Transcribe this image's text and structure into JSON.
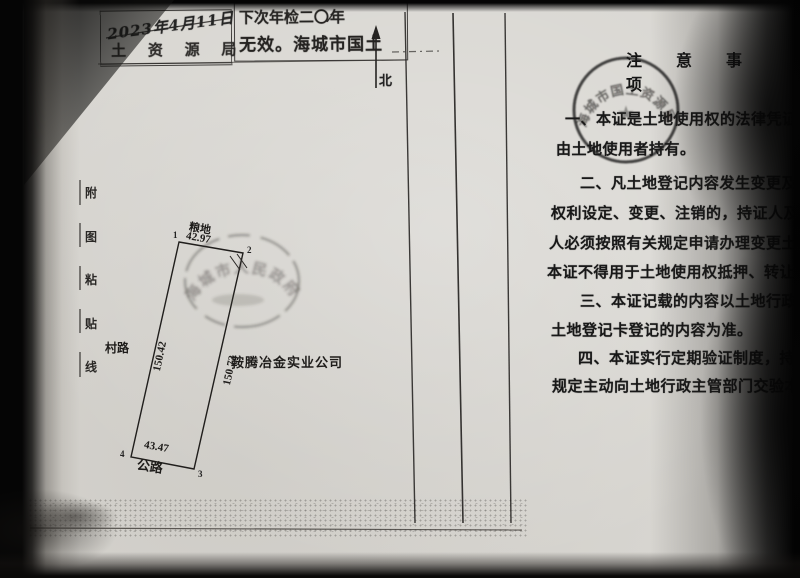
{
  "north": {
    "label": "北"
  },
  "paste_strip": {
    "chars": [
      "附",
      "图",
      "粘",
      "贴",
      "线"
    ]
  },
  "top_stamps": {
    "date_box": {
      "date": "2023年4月11日",
      "agency": "土 资 源 局"
    },
    "inspection_box": {
      "line1_prefix": "下次年检二〇",
      "line1_scribble": "⁄⁄",
      "line1_suffix": "年",
      "line2": "无效。海城市国土"
    }
  },
  "round_stamps": {
    "notice_stamp": {
      "arc_text": "海城市国土资源局",
      "star": "★"
    },
    "parcel_stamp": {
      "arc_text": "海城市人民政府"
    }
  },
  "parcel": {
    "owner": "鞍腾冶金实业公司",
    "edge_top": {
      "label": "粮地",
      "length": "42.97"
    },
    "edge_left": {
      "label": "村路",
      "length": "150.42"
    },
    "edge_right": {
      "length": "150.73"
    },
    "edge_bottom": {
      "label": "公路",
      "length": "43.47"
    },
    "corner_labels": [
      "1",
      "2",
      "3",
      "4"
    ]
  },
  "notice": {
    "title": "注 意 事 项",
    "lines": [
      "一、本证是土地使用权的法律凭证",
      "由土地使用者持有。",
      "二、凡土地登记内容发生变更及土",
      "权利设定、变更、注销的，持证人及有",
      "人必须按照有关规定申请办理变更土地",
      "本证不得用于土地使用权抵押、转让等",
      "三、本证记载的内容以土地行政主",
      "土地登记卡登记的内容为准。",
      "四、本证实行定期验证制度，持证",
      "规定主动向土地行政主管部门交验本证"
    ]
  },
  "colors": {
    "paper": "#d8d6d1",
    "ink": "#1c1c1c",
    "stamp_ink": "#2a2a2a"
  }
}
